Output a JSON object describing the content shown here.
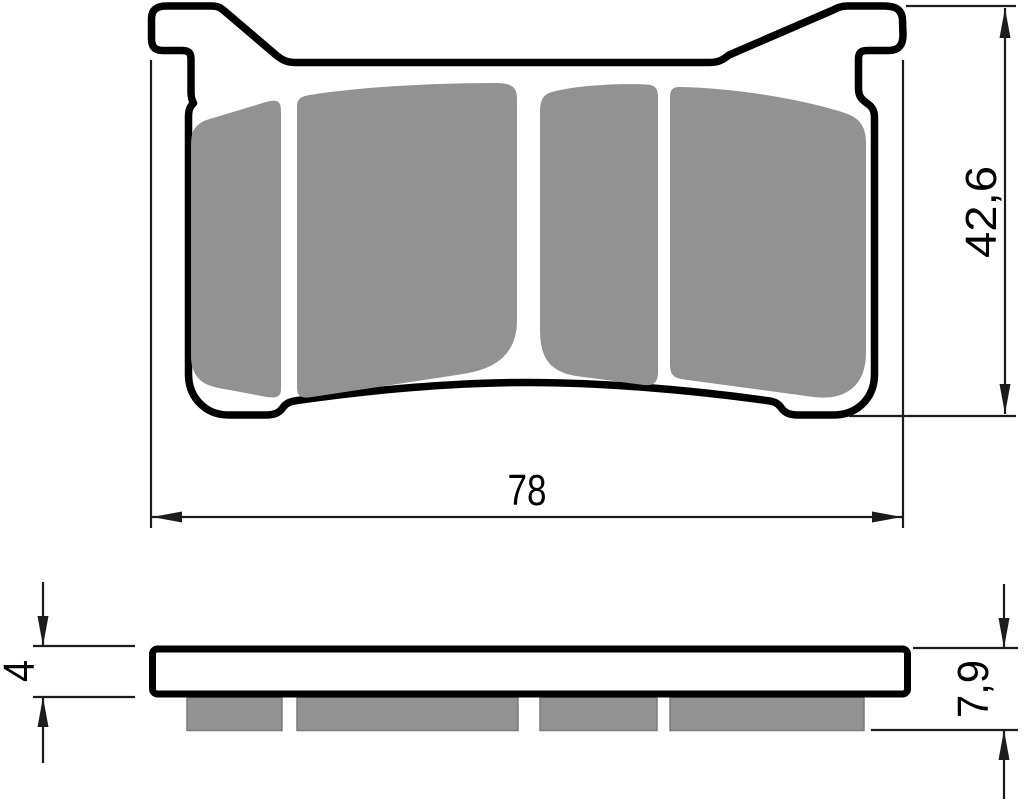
{
  "drawing": {
    "title": "Brake pad technical drawing",
    "views": {
      "top": {
        "name": "pad face view (friction surface)"
      },
      "side": {
        "name": "pad side profile view"
      }
    },
    "dimensions": {
      "width": {
        "label": "78"
      },
      "height": {
        "label": "42,6"
      },
      "backing_plate_thickness": {
        "label": "4"
      },
      "total_thickness": {
        "label": "7,9"
      }
    },
    "colors": {
      "outline": "#000000",
      "friction_material": "#929292",
      "background": "#ffffff",
      "dimension_line": "#1c1c1c",
      "text": "#000000"
    }
  }
}
